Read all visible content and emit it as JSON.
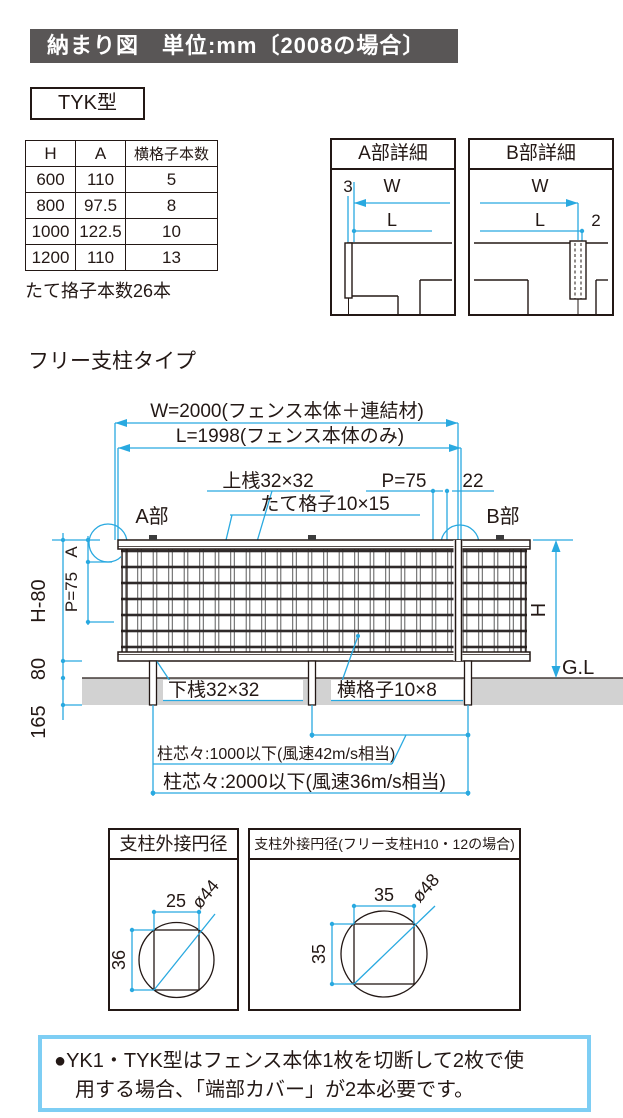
{
  "page": {
    "header": "納まり図　単位:mm〔2008の場合〕",
    "model_label": "TYK型",
    "type_label": "フリー支柱タイプ"
  },
  "spec_table": {
    "headers": [
      "H",
      "A",
      "横格子本数"
    ],
    "rows": [
      [
        "600",
        "110",
        "5"
      ],
      [
        "800",
        "97.5",
        "8"
      ],
      [
        "1000",
        "122.5",
        "10"
      ],
      [
        "1200",
        "110",
        "13"
      ]
    ],
    "note": "たて挌子本数26本"
  },
  "detail_a": {
    "title": "A部詳細",
    "dim_offset": "3",
    "dim_w": "W",
    "dim_l": "L"
  },
  "detail_b": {
    "title": "B部詳細",
    "dim_w": "W",
    "dim_l": "L",
    "dim_offset": "2"
  },
  "main_diagram": {
    "dim_w": "W=2000(フェンス本体＋連結材)",
    "dim_l": "L=1998(フェンス本体のみ)",
    "label_top_rail": "上桟32×32",
    "label_pitch": "P=75",
    "label_end": "22",
    "label_vertical_lattice": "たて格子10×15",
    "label_a_part": "A部",
    "label_b_part": "B部",
    "dim_h_minus_80": "H-80",
    "dim_a": "A",
    "dim_p75": "P=75",
    "dim_80": "80",
    "dim_165": "165",
    "dim_h": "H",
    "label_gl": "G.L",
    "label_bottom_rail": "下桟32×32",
    "label_horizontal_lattice": "横格子10×8",
    "note_span_1000": "柱芯々:1000以下(風速42m/s相当)",
    "note_span_2000": "柱芯々:2000以下(風速36m/s相当)"
  },
  "circle_detail_1": {
    "title": "支柱外接円径",
    "width": "25",
    "height": "36",
    "diameter": "ø44"
  },
  "circle_detail_2": {
    "title": "支柱外接円径(フリー支柱H10・12の場合)",
    "width": "35",
    "height": "35",
    "diameter": "ø48"
  },
  "footnote": {
    "line1": "●YK1・TYK型はフェンス本体1枚を切断して2枚で使",
    "line2": "用する場合、「端部カバー」が2本必要です。"
  },
  "colors": {
    "accent_cyan": "#29a9e0",
    "header_gray": "#595656",
    "ground_gray": "#d2d2d2",
    "note_border": "#7ecef4",
    "line_black": "#231815"
  }
}
